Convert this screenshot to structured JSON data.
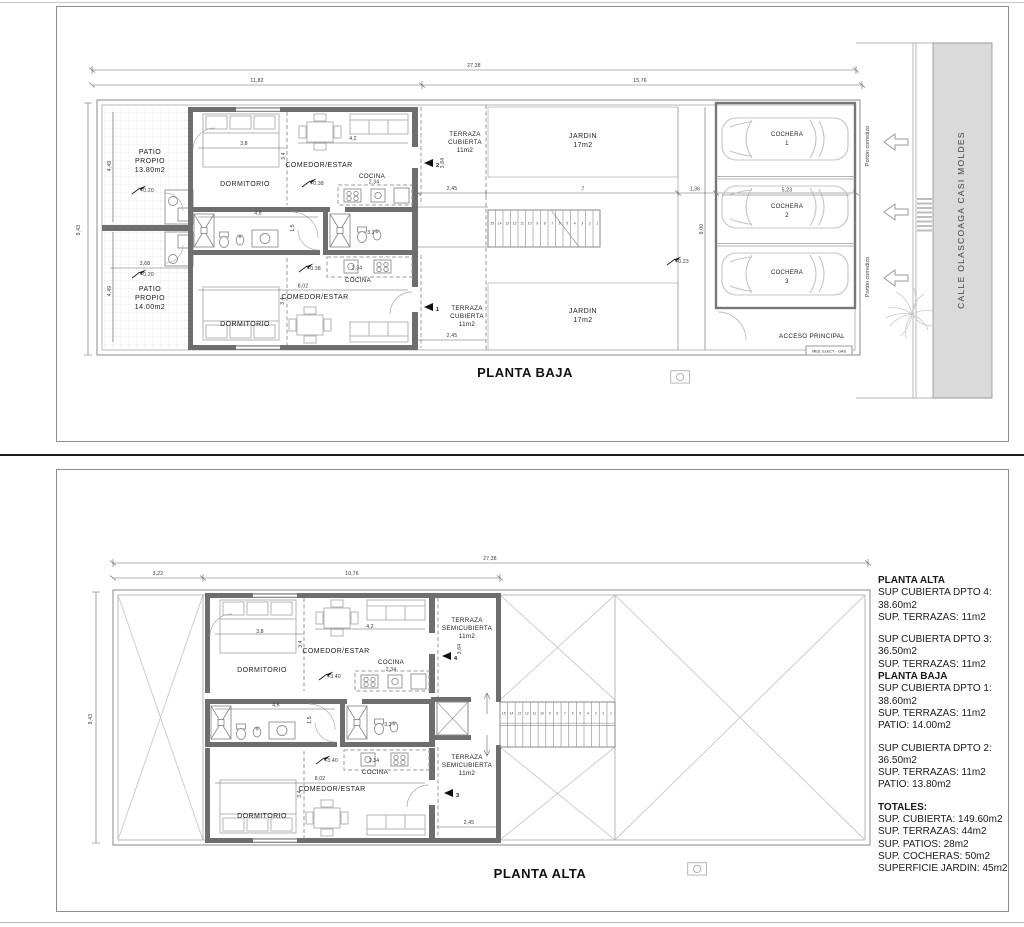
{
  "pb": {
    "title": "PLANTA BAJA",
    "dims": {
      "total": "27,38",
      "left": "11,82",
      "right": "15,76",
      "height": "9,43",
      "patio_top": "4,49",
      "patio_bottom": "4,49",
      "patio_mid": "3,68",
      "bed_top": "3,8",
      "living_top": "4,2",
      "living_depth": "3,4",
      "living_depth2": "3,4",
      "kitchen_top": "2,34",
      "kitchen_bottom": "2,34",
      "hall": "4,6",
      "hall_w": "1,5",
      "bath": "3,2",
      "living_bottom": "8,02",
      "terraza_top": "2,45",
      "terraza_bottom": "2,45",
      "terraza_h": "3,84",
      "jardin_w": "7",
      "path_w": "1,36",
      "garage_h": "9,00",
      "garage_w": "5,23"
    },
    "levels": {
      "patio_top": "+0.20",
      "patio_bottom": "+0.20",
      "apt_top": "+0.38",
      "apt_bottom": "+0.38",
      "path": "+0.23"
    },
    "rooms": {
      "patio1_1": "PATIO",
      "patio1_2": "PROPIO",
      "patio1_3": "13.80m2",
      "patio2_1": "PATIO",
      "patio2_2": "PROPIO",
      "patio2_3": "14.00m2",
      "dorm1": "DORMITORIO",
      "dorm2": "DORMITORIO",
      "living1": "COMEDOR/ESTAR",
      "living2": "COMEDOR/ESTAR",
      "cocina1": "COCINA",
      "cocina2": "COCINA",
      "terraza1_1": "TERRAZA",
      "terraza1_2": "CUBIERTA",
      "terraza1_3": "11m2",
      "terraza2_1": "TERRAZA",
      "terraza2_2": "CUBIERTA",
      "terraza2_3": "11m2",
      "jardin1_1": "JARDIN",
      "jardin1_2": "17m2",
      "jardin2_1": "JARDIN",
      "jardin2_2": "17m2",
      "cochera": "COCHERA",
      "c1": "1",
      "c2": "2",
      "c3": "3",
      "acceso": "ACCESO PRINCIPAL",
      "medidores": "MED. ELECT. - GAS"
    },
    "arrows": {
      "a1": "1",
      "a2": "2"
    },
    "street": {
      "porton1": "Portón corredizo",
      "porton2": "Portón corredizo",
      "calle": "CALLE OLASCOAGA CASI MOLDES"
    },
    "stairs": [
      "15",
      "14",
      "13",
      "12",
      "11",
      "10",
      "9",
      "8",
      "7",
      "6",
      "5",
      "4",
      "3",
      "2",
      "1"
    ]
  },
  "pa": {
    "title": "PLANTA ALTA",
    "dims": {
      "total": "27,38",
      "left": "3,22",
      "mid": "10,76",
      "height": "9,43",
      "bed_top": "3,8",
      "living_top": "4,2",
      "living_depth": "3,4",
      "living_depth2": "3,4",
      "kitchen_top": "2,34",
      "kitchen_bottom": "2,34",
      "hall": "4,6",
      "hall_w": "1,5",
      "bath": "3,2",
      "living_bottom": "8,02",
      "terraza_h": "3,84",
      "terraza_bottom": "2,45"
    },
    "levels": {
      "apt_top": "+3.40",
      "apt_bottom": "+3.40"
    },
    "rooms": {
      "dorm1": "DORMITORIO",
      "dorm2": "DORMITORIO",
      "living1": "COMEDOR/ESTAR",
      "living2": "COMEDOR/ESTAR",
      "cocina1": "COCINA",
      "cocina2": "COCINA",
      "terraza1_1": "TERRAZA",
      "terraza1_2": "SEMICUBIERTA",
      "terraza1_3": "11m2",
      "terraza2_1": "TERRAZA",
      "terraza2_2": "SEMICUBIERTA",
      "terraza2_3": "11m2"
    },
    "arrows": {
      "a3": "3",
      "a4": "4"
    },
    "stairs": [
      "15",
      "14",
      "13",
      "12",
      "11",
      "10",
      "9",
      "8",
      "7",
      "6",
      "5",
      "4",
      "3",
      "2",
      "1"
    ]
  },
  "resumen": {
    "lines": [
      {
        "b": 1,
        "t": "PLANTA ALTA"
      },
      {
        "t": "SUP CUBIERTA DPTO 4:"
      },
      {
        "t": "38.60m2"
      },
      {
        "t": "SUP. TERRAZAS: 11m2"
      },
      {
        "gap": 1,
        "t": "SUP CUBIERTA DPTO 3:"
      },
      {
        "t": "36.50m2"
      },
      {
        "t": "SUP. TERRAZAS: 11m2"
      },
      {
        "b": 1,
        "t": "PLANTA BAJA"
      },
      {
        "t": "SUP CUBIERTA DPTO 1:"
      },
      {
        "t": "38.60m2"
      },
      {
        "t": "SUP. TERRAZAS: 11m2"
      },
      {
        "t": "PATIO: 14.00m2"
      },
      {
        "gap": 1,
        "t": "SUP CUBIERTA DPTO 2:"
      },
      {
        "t": "36.50m2"
      },
      {
        "t": "SUP. TERRAZAS: 11m2"
      },
      {
        "t": "PATIO: 13.80m2"
      },
      {
        "b": 1,
        "gap": 1,
        "t": "TOTALES:"
      },
      {
        "t": "SUP. CUBIERTA: 149.60m2"
      },
      {
        "t": "SUP. TERRAZAS: 44m2"
      },
      {
        "t": "SUP. PATIOS: 28m2"
      },
      {
        "t": "SUP. COCHERAS: 50m2"
      },
      {
        "t": "SUPERFICIE JARDIN: 45m2"
      }
    ]
  }
}
